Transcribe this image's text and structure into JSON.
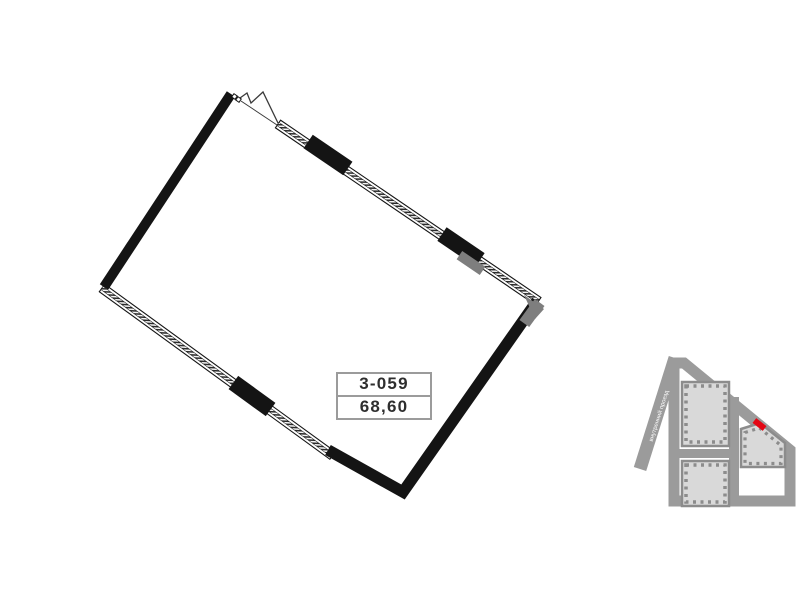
{
  "plan": {
    "unit_number": "3-059",
    "unit_area": "68,60",
    "colors": {
      "wall_black": "#141414",
      "window_frame": "#141414",
      "concrete_gray": "#7e7e7e",
      "info_box_border": "#9b9b9b",
      "info_text": "#2e2e2e"
    }
  },
  "minimap": {
    "street_label": "внутренний проезд",
    "marker_icon": "unit-location-marker",
    "colors": {
      "road_gray": "#9b9b9b",
      "building_fill": "#d9d9d9",
      "building_wall": "#8c8c8c",
      "marker_red": "#e30613",
      "street_text": "#ffffff"
    }
  }
}
